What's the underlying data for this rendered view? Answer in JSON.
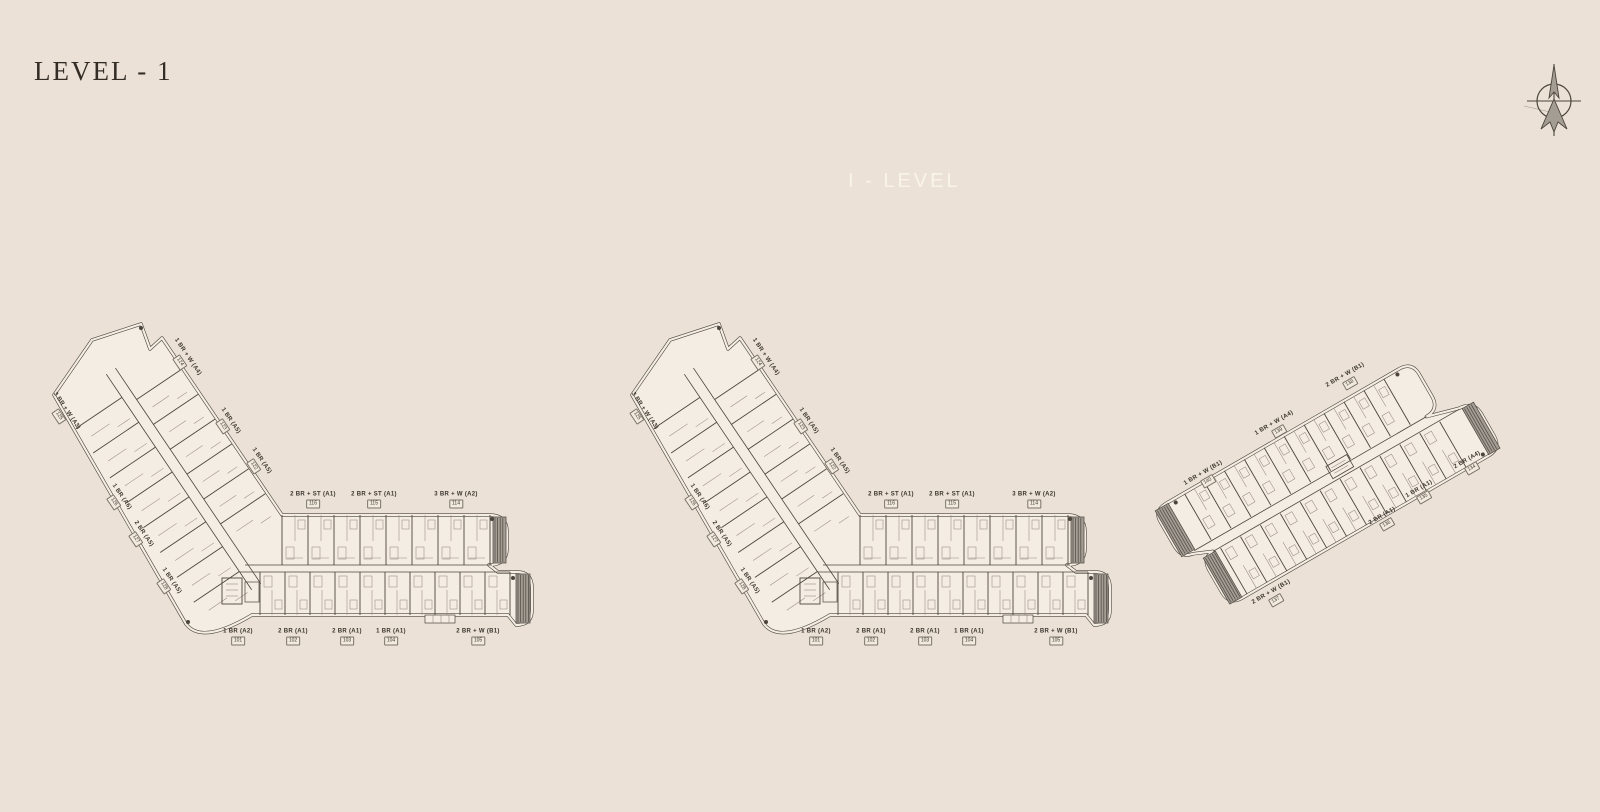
{
  "page": {
    "title": "LEVEL - 1",
    "watermark": "I - LEVEL"
  },
  "colors": {
    "background": "#ebe1d6",
    "plan_fill": "#f4ede3",
    "line": "#4b453d",
    "line_faint": "#968c80",
    "cap_fill": "#a49d93",
    "cap_line": "#55504a",
    "title_text": "#332d26",
    "watermark_text": "#f9f4eb",
    "label_text": "#3b352e",
    "label_box_border": "#7c7469",
    "label_box_fill": "#f2eadf"
  },
  "compass": {
    "icon": "north-arrow-compass"
  },
  "plans": [
    {
      "id": "building-1",
      "shape": "l-shape",
      "labels": [
        {
          "text": "1 BR + W (A4)",
          "unit": "124",
          "x": 183,
          "y": 360,
          "rot": 56
        },
        {
          "text": "1 BR (A5)",
          "unit": "123",
          "x": 226,
          "y": 424,
          "rot": 56
        },
        {
          "text": "1 BR (A5)",
          "unit": "122",
          "x": 257,
          "y": 464,
          "rot": 56
        },
        {
          "text": "3 BR + W (A3)",
          "unit": "125",
          "x": 62,
          "y": 414,
          "rot": 56
        },
        {
          "text": "1 BR (A6)",
          "unit": "126",
          "x": 117,
          "y": 500,
          "rot": 56
        },
        {
          "text": "2 BR (A5)",
          "unit": "127",
          "x": 139,
          "y": 537,
          "rot": 56
        },
        {
          "text": "1 BR (A5)",
          "unit": "128",
          "x": 167,
          "y": 584,
          "rot": 56
        },
        {
          "text": "2 BR + ST (A1)",
          "unit": "116",
          "x": 313,
          "y": 500,
          "rot": 0
        },
        {
          "text": "2 BR + ST (A1)",
          "unit": "115",
          "x": 374,
          "y": 500,
          "rot": 0
        },
        {
          "text": "3 BR + W (A2)",
          "unit": "114",
          "x": 456,
          "y": 500,
          "rot": 0
        },
        {
          "text": "1 BR (A2)",
          "unit": "101",
          "x": 238,
          "y": 637,
          "rot": 0
        },
        {
          "text": "2 BR (A1)",
          "unit": "102",
          "x": 293,
          "y": 637,
          "rot": 0
        },
        {
          "text": "2 BR (A1)",
          "unit": "103",
          "x": 347,
          "y": 637,
          "rot": 0
        },
        {
          "text": "1 BR (A1)",
          "unit": "104",
          "x": 391,
          "y": 637,
          "rot": 0
        },
        {
          "text": "2 BR + W (B1)",
          "unit": "105",
          "x": 478,
          "y": 637,
          "rot": 0
        }
      ]
    },
    {
      "id": "building-2",
      "shape": "l-shape",
      "labels": [
        {
          "text": "1 BR + W (A4)",
          "unit": "124",
          "x": 761,
          "y": 360,
          "rot": 56
        },
        {
          "text": "1 BR (A5)",
          "unit": "123",
          "x": 804,
          "y": 424,
          "rot": 56
        },
        {
          "text": "1 BR (A5)",
          "unit": "122",
          "x": 835,
          "y": 464,
          "rot": 56
        },
        {
          "text": "3 BR + W (A3)",
          "unit": "125",
          "x": 640,
          "y": 414,
          "rot": 56
        },
        {
          "text": "1 BR (A6)",
          "unit": "126",
          "x": 695,
          "y": 500,
          "rot": 56
        },
        {
          "text": "2 BR (A5)",
          "unit": "127",
          "x": 717,
          "y": 537,
          "rot": 56
        },
        {
          "text": "1 BR (A5)",
          "unit": "128",
          "x": 745,
          "y": 584,
          "rot": 56
        },
        {
          "text": "2 BR + ST (A1)",
          "unit": "116",
          "x": 891,
          "y": 500,
          "rot": 0
        },
        {
          "text": "2 BR + ST (A1)",
          "unit": "115",
          "x": 952,
          "y": 500,
          "rot": 0
        },
        {
          "text": "3 BR + W (A2)",
          "unit": "114",
          "x": 1034,
          "y": 500,
          "rot": 0
        },
        {
          "text": "1 BR (A2)",
          "unit": "101",
          "x": 816,
          "y": 637,
          "rot": 0
        },
        {
          "text": "2 BR (A1)",
          "unit": "102",
          "x": 871,
          "y": 637,
          "rot": 0
        },
        {
          "text": "2 BR (A1)",
          "unit": "103",
          "x": 925,
          "y": 637,
          "rot": 0
        },
        {
          "text": "1 BR (A1)",
          "unit": "104",
          "x": 969,
          "y": 637,
          "rot": 0
        },
        {
          "text": "2 BR + W (B1)",
          "unit": "105",
          "x": 1056,
          "y": 637,
          "rot": 0
        }
      ]
    },
    {
      "id": "building-3",
      "shape": "bar",
      "labels": [
        {
          "text": "2 BR + W (B1)",
          "unit": "138",
          "x": 1348,
          "y": 380,
          "rot": -30
        },
        {
          "text": "1 BR + W (A4)",
          "unit": "139",
          "x": 1277,
          "y": 428,
          "rot": -30
        },
        {
          "text": "1 BR + W (B1)",
          "unit": "140",
          "x": 1206,
          "y": 478,
          "rot": -30
        },
        {
          "text": "2 BR (A4)",
          "unit": "134",
          "x": 1470,
          "y": 465,
          "rot": -30
        },
        {
          "text": "1 BR (A1)",
          "unit": "135",
          "x": 1422,
          "y": 494,
          "rot": -30
        },
        {
          "text": "2 BR (A1)",
          "unit": "136",
          "x": 1385,
          "y": 521,
          "rot": -30
        },
        {
          "text": "2 BR + W (B1)",
          "unit": "137",
          "x": 1274,
          "y": 597,
          "rot": -30
        }
      ]
    }
  ]
}
